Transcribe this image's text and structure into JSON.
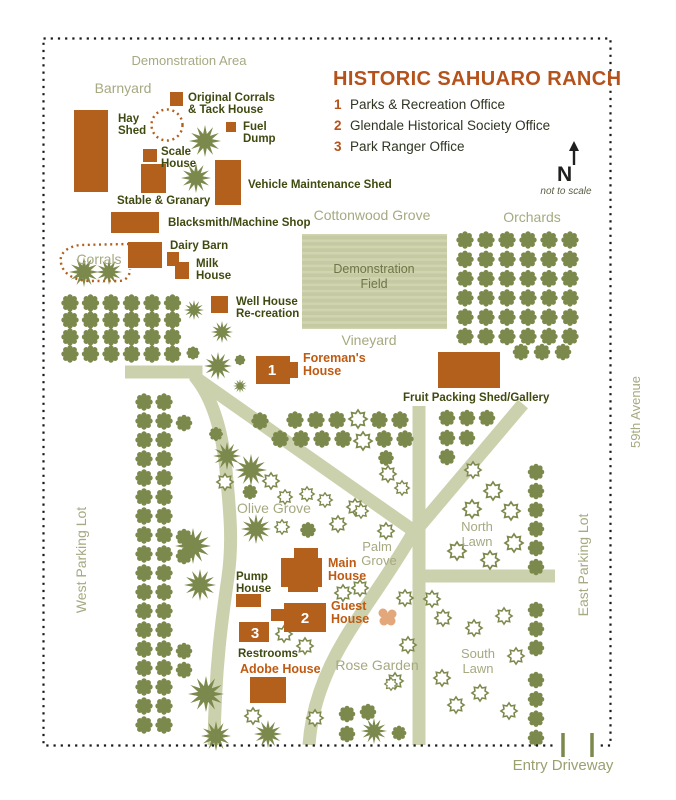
{
  "header": {
    "title": "HISTORIC SAHUARO RANCH",
    "legend": [
      {
        "num": "1",
        "label": "Parks & Recreation Office"
      },
      {
        "num": "2",
        "label": "Glendale Historical Society Office"
      },
      {
        "num": "3",
        "label": "Park Ranger Office"
      }
    ]
  },
  "compass": {
    "n": "N",
    "note": "not to scale"
  },
  "labels": {
    "hay_shed": [
      "Hay",
      "Shed"
    ],
    "original_corrals": [
      "Original Corrals",
      "& Tack House"
    ],
    "fuel_dump": [
      "Fuel",
      "Dump"
    ],
    "scale_house": [
      "Scale",
      "House"
    ],
    "stable_granary": [
      "Stable & Granary"
    ],
    "vehicle_shed": [
      "Vehicle Maintenance Shed"
    ],
    "blacksmith": [
      "Blacksmith/Machine Shop"
    ],
    "dairy_barn": [
      "Dairy Barn"
    ],
    "milk_house": [
      "Milk",
      "House"
    ],
    "well_house": [
      "Well House",
      "Re-creation"
    ],
    "foremans_house": [
      "Foreman's",
      "House"
    ],
    "fruit_packing": [
      "Fruit Packing Shed/Gallery"
    ],
    "main_house": [
      "Main",
      "House"
    ],
    "guest_house": [
      "Guest",
      "House"
    ],
    "pump_house": [
      "Pump",
      "House"
    ],
    "restrooms": [
      "Restrooms"
    ],
    "adobe_house": [
      "Adobe House"
    ]
  },
  "areas": {
    "demonstration_area": "Demonstration Area",
    "barnyard": "Barnyard",
    "corrals": "Corrals",
    "cottonwood_grove": "Cottonwood Grove",
    "orchards": "Orchards",
    "demonstration_field": [
      "Demonstration",
      "Field"
    ],
    "vineyard": "Vineyard",
    "olive_grove": "Olive Grove",
    "palm_grove": [
      "Palm",
      "Grove"
    ],
    "north_lawn": [
      "North",
      "Lawn"
    ],
    "south_lawn": [
      "South",
      "Lawn"
    ],
    "rose_garden": "Rose Garden",
    "west_parking": "West Parking Lot",
    "east_parking": "East Parking Lot",
    "street": "59th Avenue",
    "entry_driveway": "Entry Driveway"
  },
  "colors": {
    "building": "#b2601c",
    "title_brown": "#b5521b",
    "orange_label": "#bf5a12",
    "dark_green_label": "#3f4a10",
    "area_label": "#a6a981",
    "tree": "#7c894c",
    "path": "#ccd1ad",
    "field": "#c6caa2",
    "flower_pink": "#e2a87c",
    "border_dot": "#1a1a1a"
  }
}
